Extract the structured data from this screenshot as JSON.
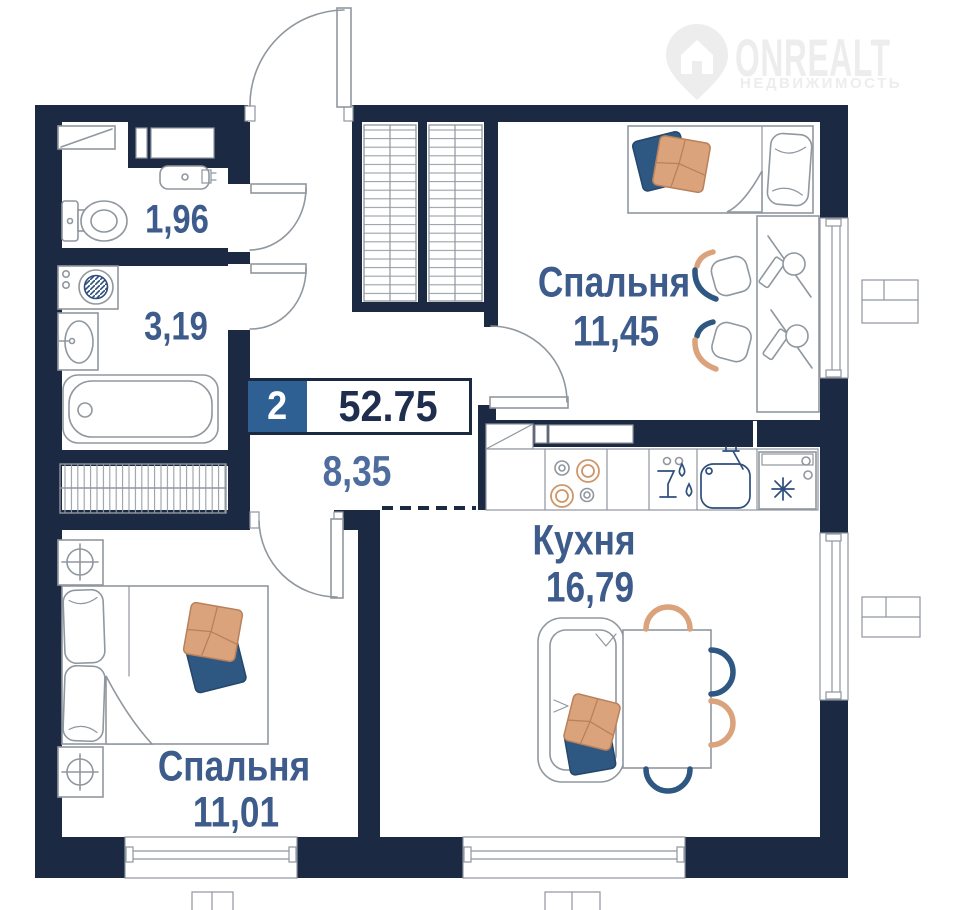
{
  "logo": {
    "name": "ONREALT",
    "subtitle": "НЕДВИЖИМОСТЬ",
    "icon": "map-pin-house-icon"
  },
  "plan": {
    "badge": {
      "rooms_count": "2",
      "total_area": "52.75"
    },
    "rooms": [
      {
        "name": "bedroom-top",
        "label": "Спальня",
        "area": "11,45"
      },
      {
        "name": "kitchen",
        "label": "Кухня",
        "area": "16,79"
      },
      {
        "name": "bedroom-bottom",
        "label": "Спальня",
        "area": "11,01"
      },
      {
        "name": "wc",
        "label": "",
        "area": "1,96"
      },
      {
        "name": "bathroom",
        "label": "",
        "area": "3,19"
      },
      {
        "name": "hallway",
        "label": "",
        "area": "8,35"
      }
    ],
    "colors": {
      "wall": "#1b2942",
      "room_label": "#3d5c8b",
      "hall_label": "#4e6d9e",
      "badge_value": "#1f2e4e",
      "badge_bg": "#2f6094",
      "furniture_line": "#8f979f",
      "accent_orange": "#dba37c",
      "accent_blue": "#2e5781",
      "logo_watermark": "#ededed"
    },
    "furniture_icons": [
      "single-bed",
      "desk",
      "desk-chairs",
      "double-bed",
      "nightstand-lamp",
      "wardrobe",
      "closet-rail",
      "sofa",
      "dining-table",
      "dining-chairs",
      "stove",
      "dishwasher",
      "kitchen-sink",
      "fridge-snowflake",
      "bathtub",
      "washbasin",
      "washing-machine",
      "toilet",
      "mirror-shelf",
      "vent-shaft",
      "window",
      "door-arc"
    ]
  }
}
